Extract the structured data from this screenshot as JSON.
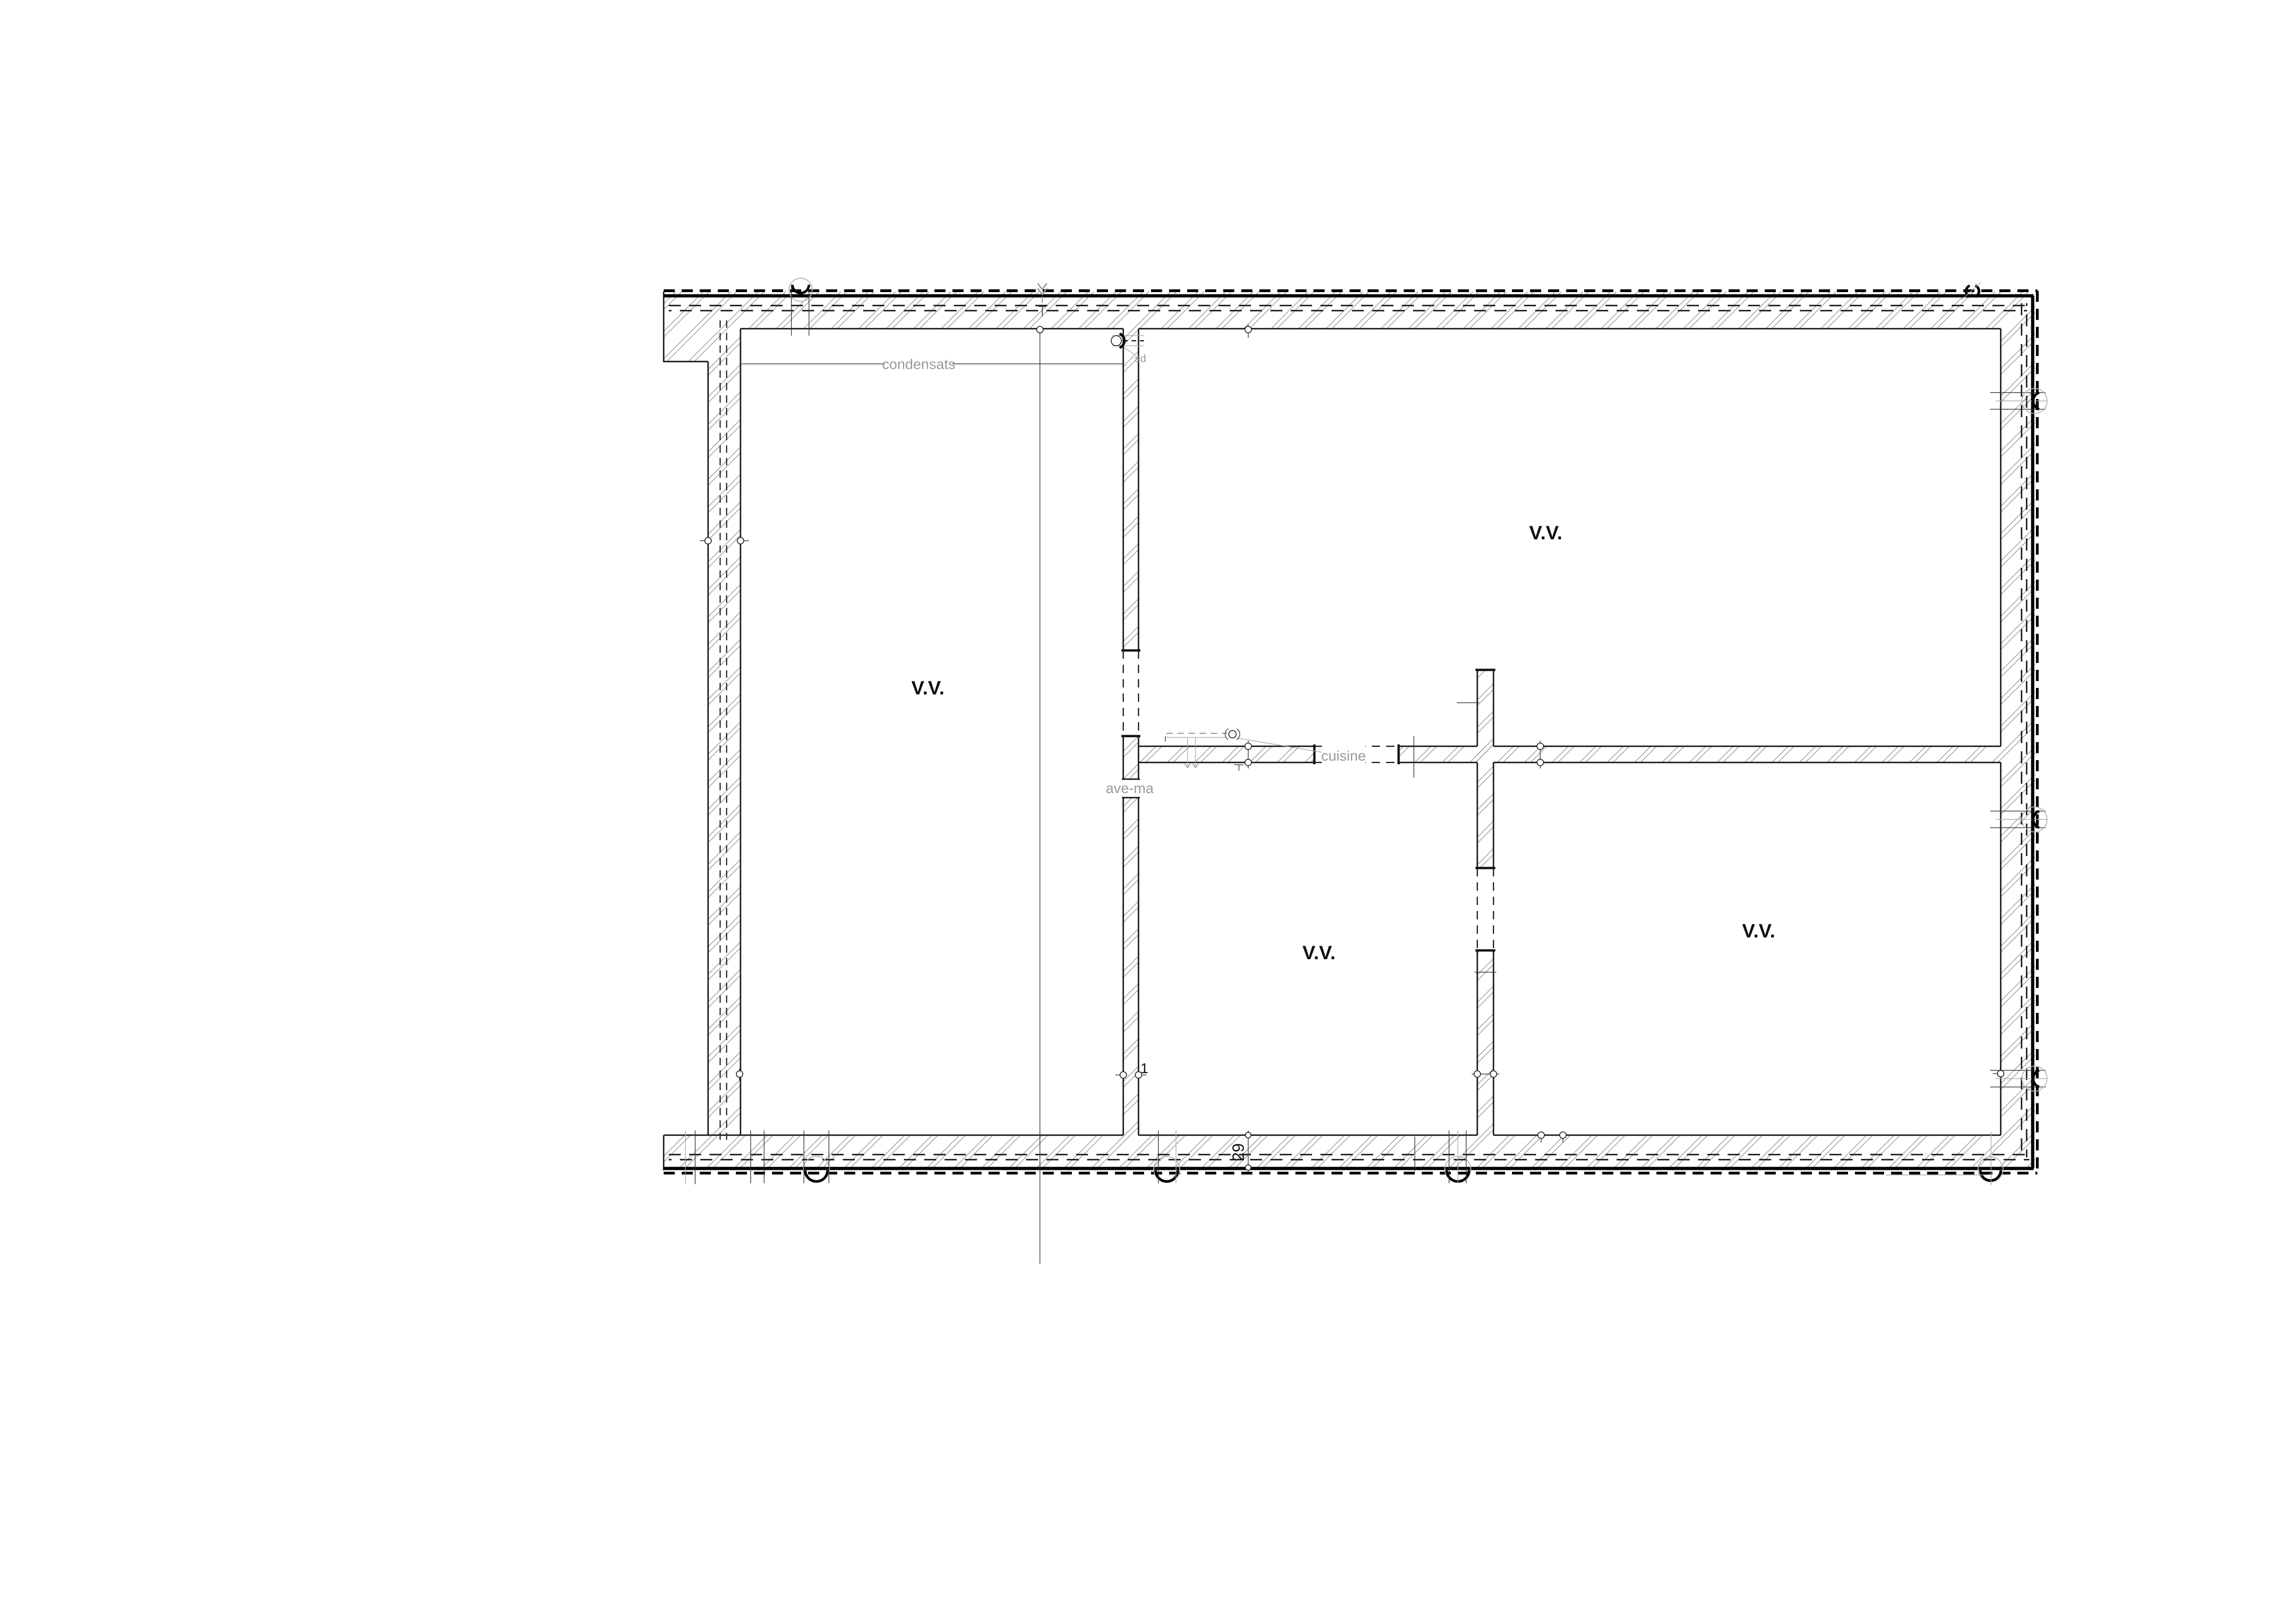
{
  "drawing": {
    "type": "floor-plan",
    "background": "#ffffff",
    "rooms": [
      {
        "id": "room-left",
        "label": "V.V."
      },
      {
        "id": "room-top-right",
        "label": "V.V."
      },
      {
        "id": "room-bottom-middle",
        "label": "V.V."
      },
      {
        "id": "room-bottom-right",
        "label": "V.V."
      }
    ],
    "annotations": {
      "condensats": "condensats",
      "cuisine": "cuisine",
      "washer": "ave-ma",
      "sd": "sd"
    },
    "marks": {
      "door_number": "1",
      "wall_thickness": "29"
    },
    "colors": {
      "line": "#111111",
      "hatch": "#999999",
      "gray_text": "#9a9a9a",
      "background": "#ffffff"
    }
  }
}
